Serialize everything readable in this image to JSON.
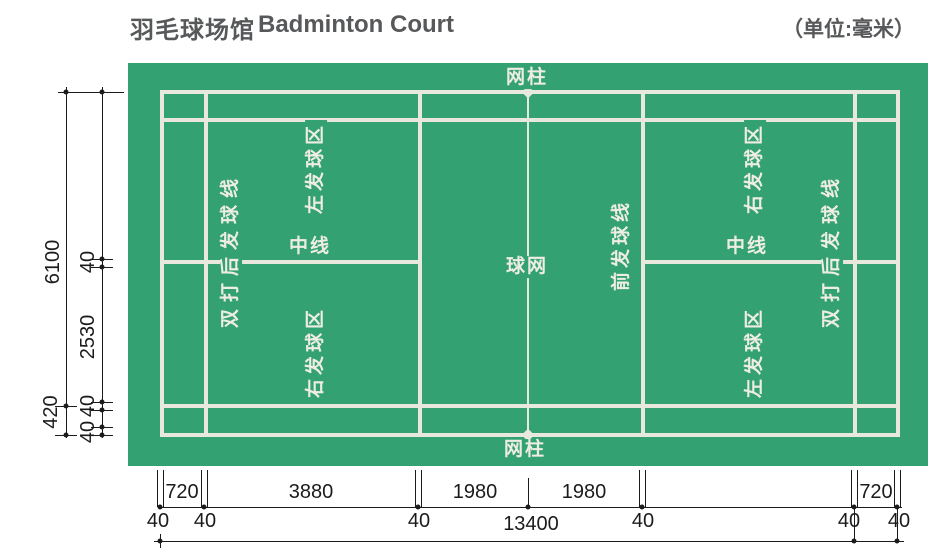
{
  "header": {
    "title_zh": "羽毛球场馆",
    "title_en": "Badminton Court",
    "unit_note": "（单位:毫米）"
  },
  "court": {
    "labels": {
      "net_post_top": "网柱",
      "net_post_bottom": "网柱",
      "net": "球网",
      "center_line_left": "中线",
      "center_line_right": "中线",
      "front_service_line": "前发球线",
      "service_box_top_left": "左发球区",
      "service_box_bottom_left": "右发球区",
      "service_box_top_right": "右发球区",
      "service_box_bottom_right": "左发球区",
      "doubles_long_service_line_left": "双打后发球线",
      "doubles_long_service_line_right": "双打后发球线"
    },
    "colors": {
      "surface_green": "#34a173",
      "line_white": "#e9e8dd",
      "dimension_ink": "#1b1b1b",
      "title_gray": "#57585a"
    }
  },
  "dimensions": {
    "vertical": {
      "court_width_total": "6100",
      "side_alley": "420",
      "center_line_width": "40",
      "half_width": "2530",
      "singles_line_width": "40",
      "doubles_line_width": "40"
    },
    "horizontal": {
      "back_alley_left": "720",
      "rear_court_left": "3880",
      "front_court_left": "1980",
      "front_court_right": "1980",
      "back_alley_right": "720",
      "court_length_total": "13400",
      "lw1": "40",
      "lw2": "40",
      "lw3": "40",
      "lw4": "40",
      "lw5": "40",
      "lw6": "40"
    }
  }
}
